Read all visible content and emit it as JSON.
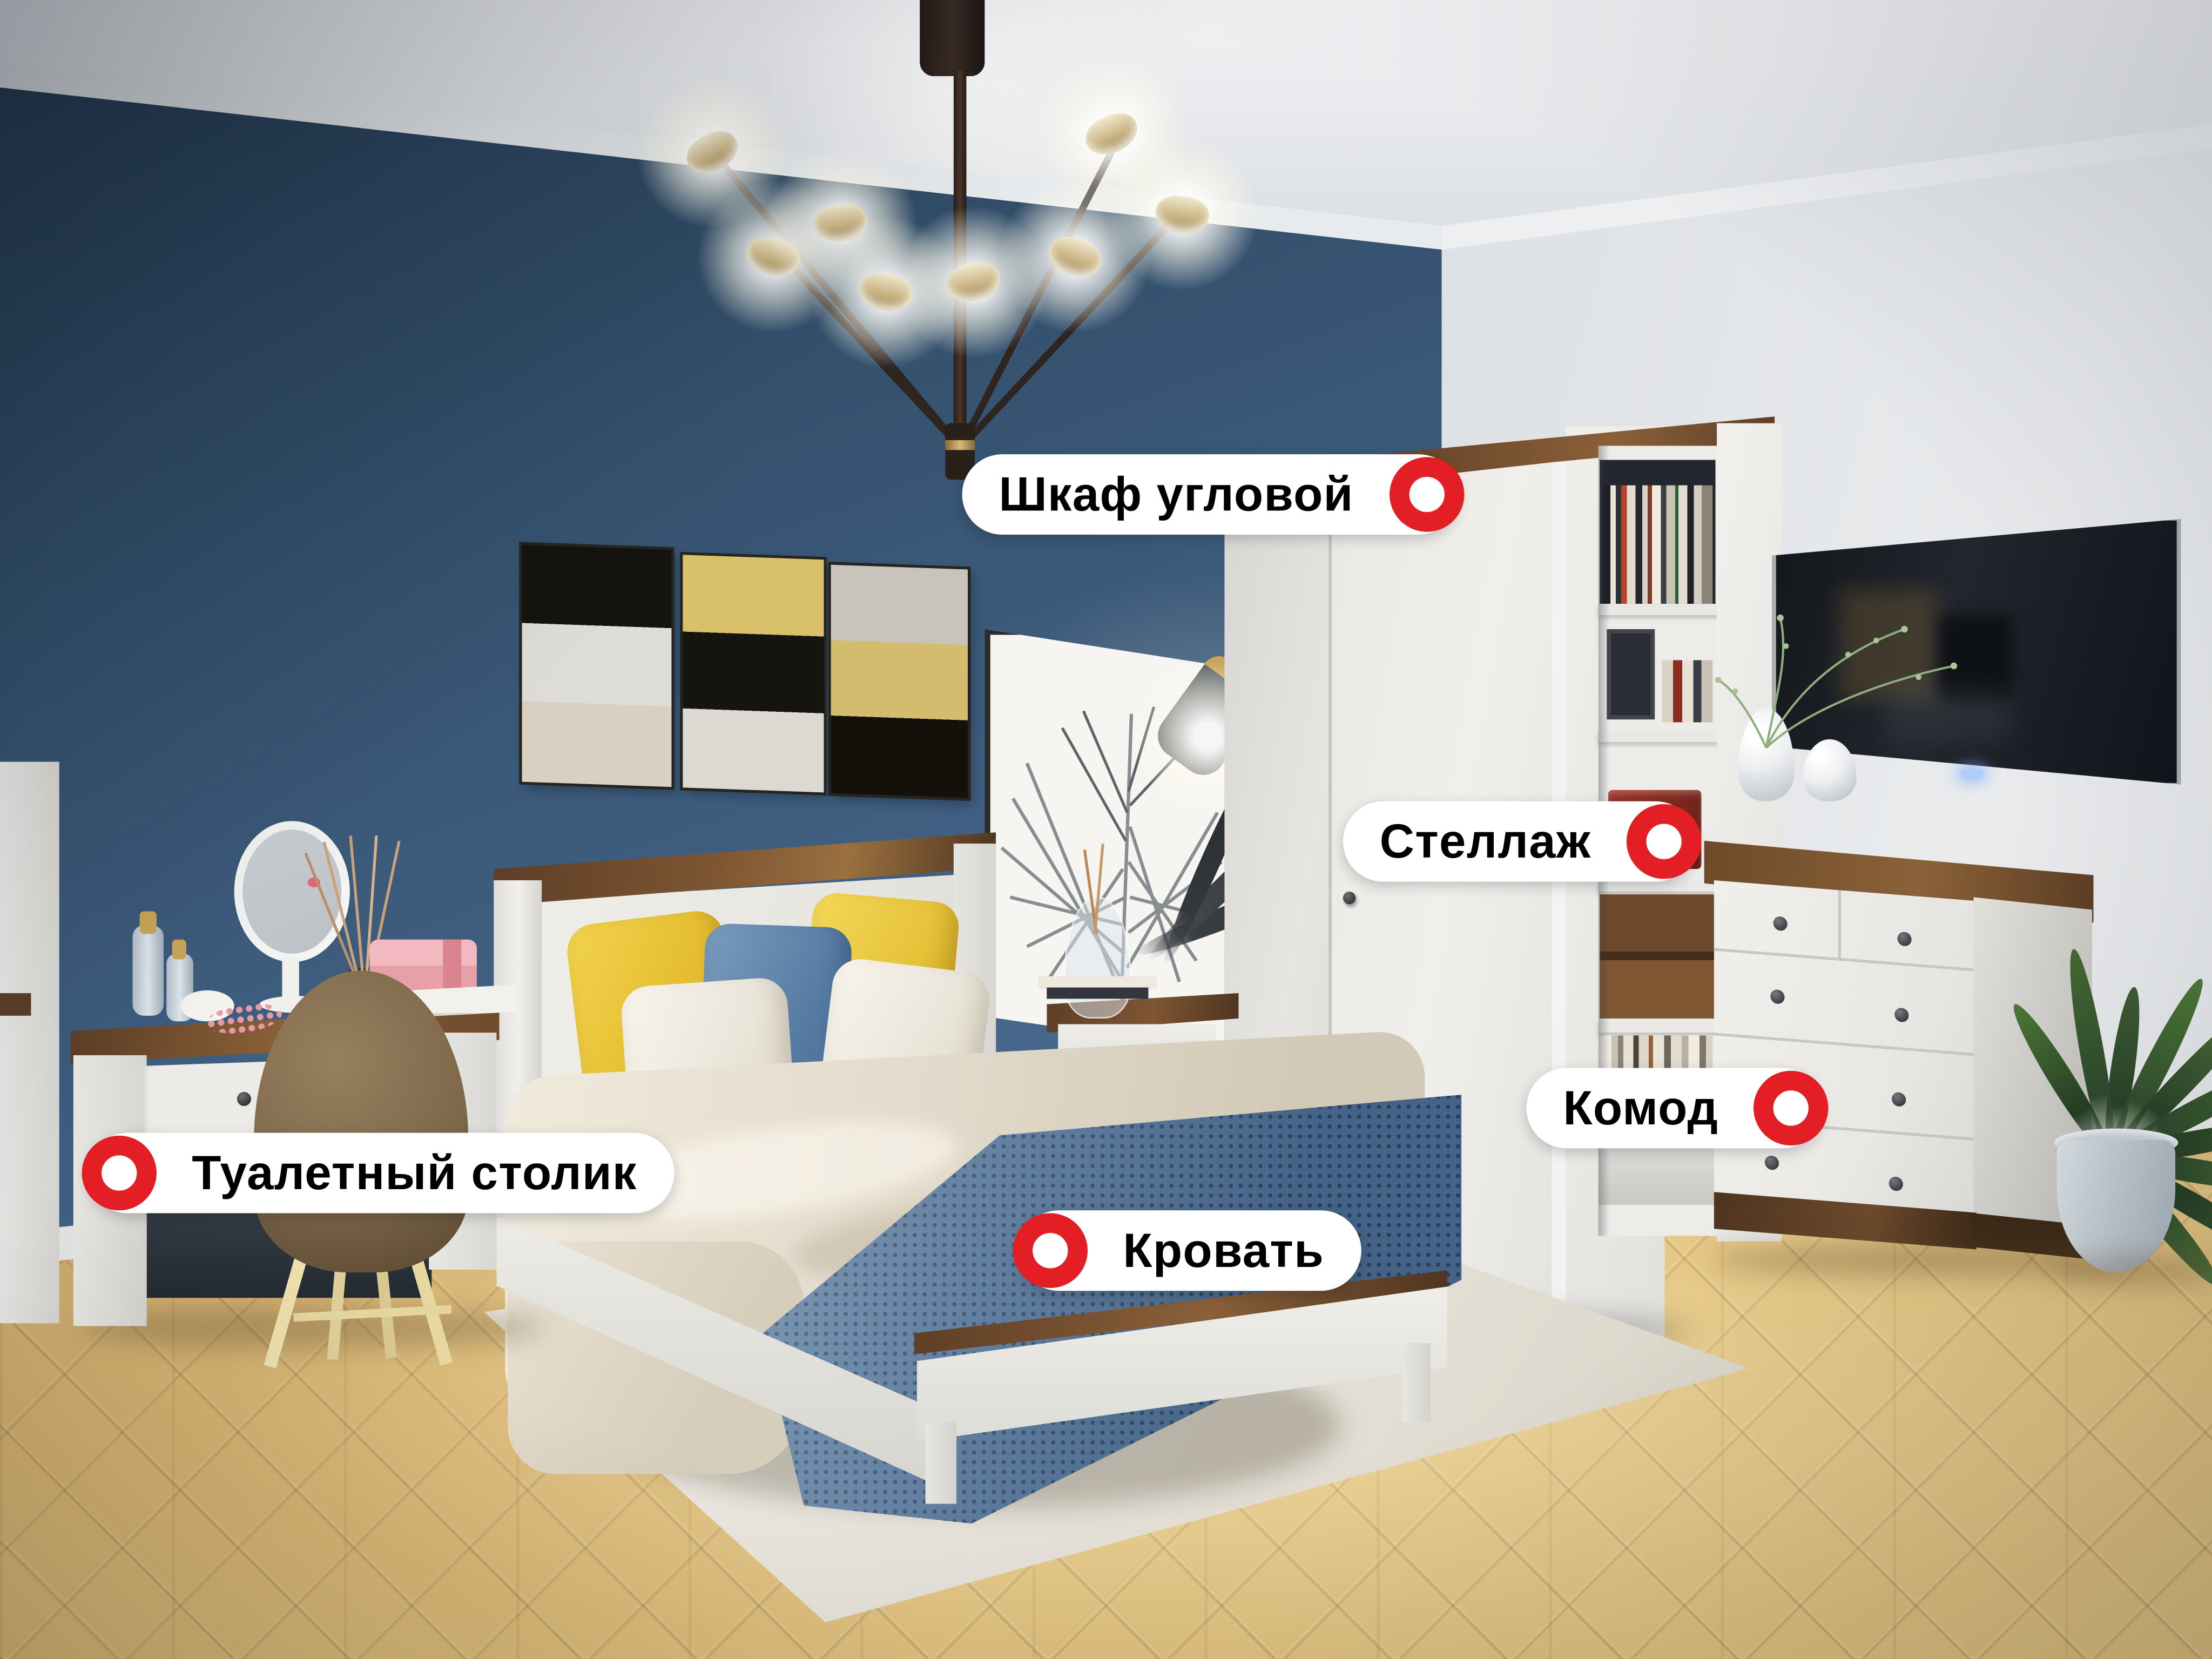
{
  "labels": [
    {
      "id": "corner-wardrobe",
      "text": "Шкаф угловой",
      "marker_side": "right"
    },
    {
      "id": "shelving-unit",
      "text": "Стеллаж",
      "marker_side": "right"
    },
    {
      "id": "chest-of-drawers",
      "text": "Комод",
      "marker_side": "left-of-ring"
    },
    {
      "id": "bed",
      "text": "Кровать",
      "marker_side": "left"
    },
    {
      "id": "vanity-table",
      "text": "Туалетный столик",
      "marker_side": "left"
    }
  ],
  "style": {
    "marker_red": "#E31E24",
    "label_bg": "#FFFFFF",
    "label_text": "#000000",
    "wall_accent_blue": "#3C5B7C",
    "wall_gray": "#DADEE2",
    "floor_oak": "#E2C17F",
    "wood_walnut": "#6E4A2C",
    "furniture_white": "#EDECE8",
    "blanket_blue": "#5E81A6",
    "pillow_yellow": "#E9C837"
  }
}
